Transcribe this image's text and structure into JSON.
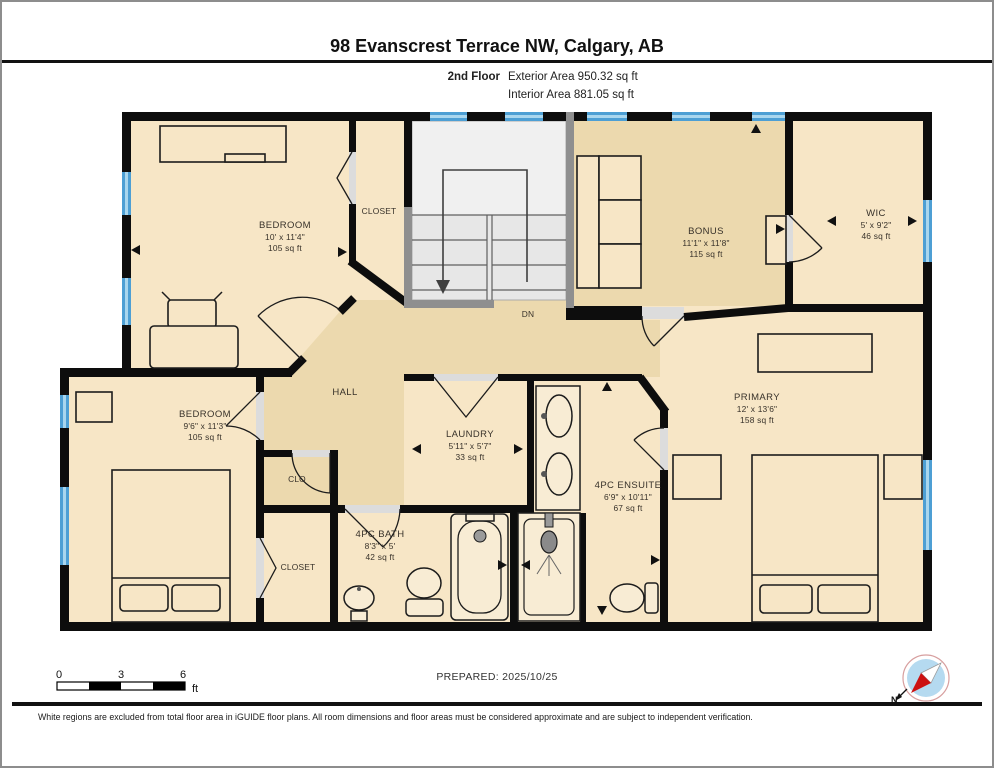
{
  "header": {
    "title": "98 Evanscrest Terrace NW, Calgary, AB",
    "floor_label": "2nd Floor",
    "exterior_area": "Exterior Area 950.32 sq ft",
    "interior_area": "Interior Area 881.05 sq ft"
  },
  "rooms": {
    "bedroom_top": {
      "name": "BEDROOM",
      "dims": "10' x 11'4\"",
      "area": "105 sq ft"
    },
    "closet_top": {
      "name": "CLOSET"
    },
    "bonus": {
      "name": "BONUS",
      "dims": "11'1\" x 11'8\"",
      "area": "115 sq ft"
    },
    "wic": {
      "name": "WIC",
      "dims": "5' x 9'2\"",
      "area": "46 sq ft"
    },
    "bedroom_left": {
      "name": "BEDROOM",
      "dims": "9'6\" x 11'3\"",
      "area": "105 sq ft"
    },
    "hall": {
      "name": "HALL"
    },
    "laundry": {
      "name": "LAUNDRY",
      "dims": "5'11\" x 5'7\"",
      "area": "33 sq ft"
    },
    "primary": {
      "name": "PRIMARY",
      "dims": "12' x 13'6\"",
      "area": "158 sq ft"
    },
    "ensuite": {
      "name": "4PC ENSUITE",
      "dims": "6'9\" x 10'11\"",
      "area": "67 sq ft"
    },
    "clo": {
      "name": "CLO"
    },
    "closet_bottom": {
      "name": "CLOSET"
    },
    "bath": {
      "name": "4PC BATH",
      "dims": "8'3\" x 5'",
      "area": "42 sq ft"
    },
    "stairs": {
      "down_label": "DN"
    }
  },
  "footer": {
    "scale_ticks": [
      "0",
      "3",
      "6"
    ],
    "scale_unit": "ft",
    "prepared_label": "PREPARED: 2025/10/25",
    "compass_north_label": "N",
    "disclaimer": "White regions are excluded from total floor area in iGUIDE floor plans. All room dimensions and floor areas must be considered approximate and are subject to independent verification."
  },
  "colors": {
    "room_fill": "#f7e6c6",
    "hall_fill": "#ecd9ae",
    "wall": "#0d0d0d",
    "window": "#4d9fd4",
    "stairs_fill": "#e7e7e7"
  }
}
